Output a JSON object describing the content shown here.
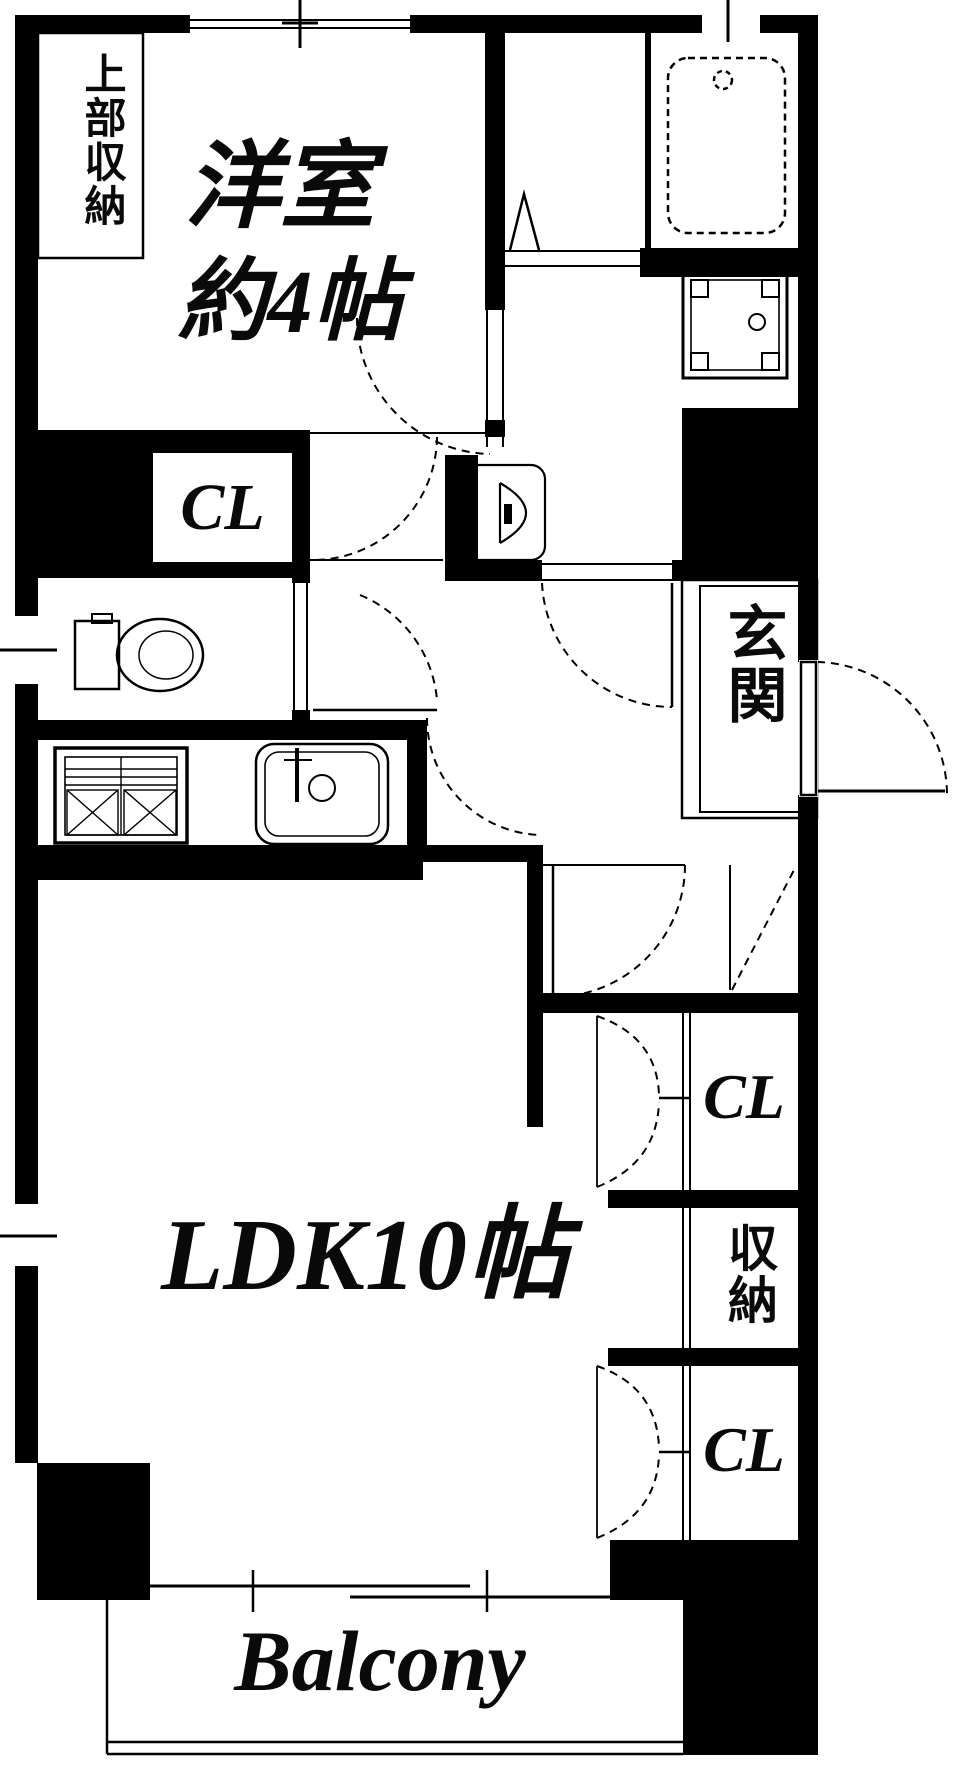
{
  "plan": {
    "type": "japanese-apartment-floor-plan",
    "colors": {
      "background": "#ffffff",
      "walls": "#000000",
      "text": "#0a0a0a"
    },
    "labels": {
      "upper_storage": "上部収納",
      "western_room_line1": "洋室",
      "western_room_line2": "約4帖",
      "closet_upper": "CL",
      "entrance": "玄関",
      "closet_mid": "CL",
      "storage": "収納",
      "closet_lower": "CL",
      "ldk": "LDK10帖",
      "balcony": "Balcony"
    },
    "fixtures": [
      "bathtub",
      "washing-machine-pan",
      "washbasin",
      "toilet",
      "gas-stove",
      "kitchen-sink",
      "entrance-swing-door",
      "sliding-window",
      "folding-bath-door",
      "door-swing-arcs",
      "bifold-closet-doors"
    ]
  }
}
